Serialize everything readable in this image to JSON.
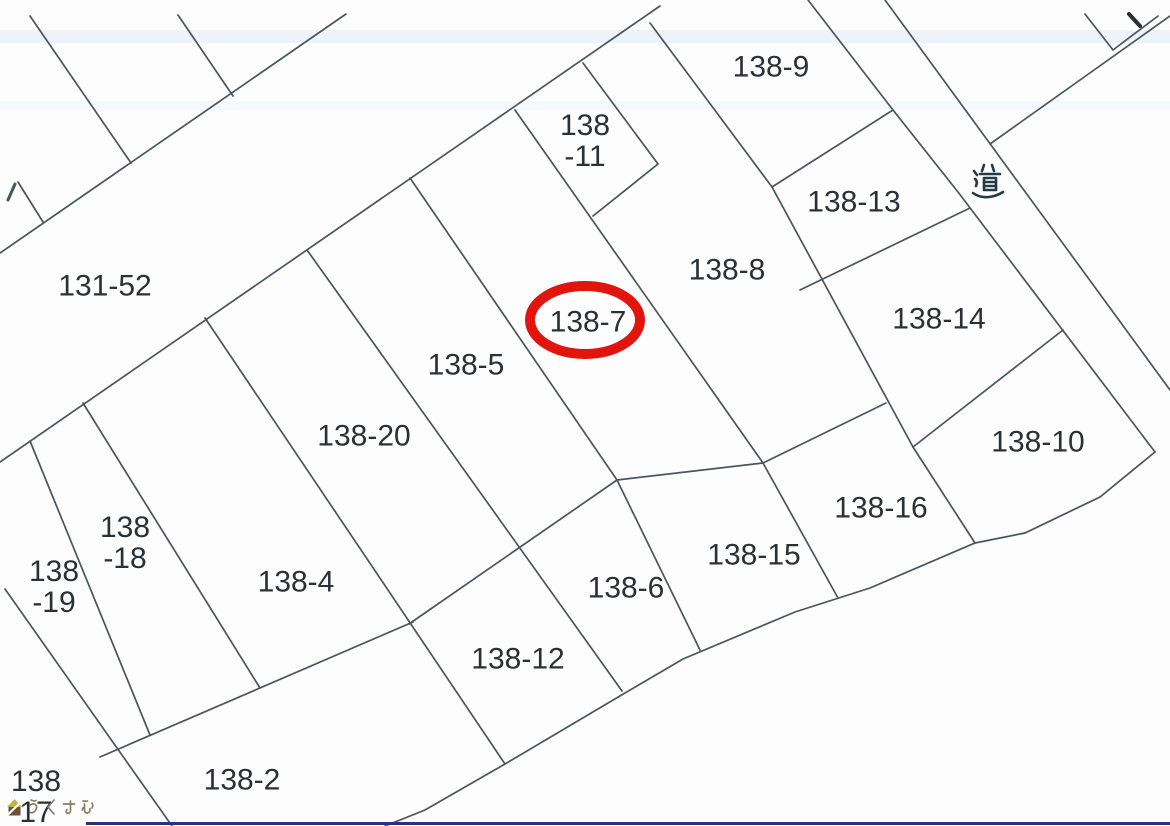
{
  "map": {
    "kind": "cadastral-parcel-map",
    "road_label": "道",
    "highlight": {
      "target_parcel": "138-7",
      "shape": "red-ellipse",
      "color": "#e2140e"
    }
  },
  "parcels": [
    {
      "id": "131-52",
      "lines": [
        "131-52"
      ]
    },
    {
      "id": "138-11",
      "lines": [
        "138",
        "-11"
      ]
    },
    {
      "id": "138-9",
      "lines": [
        "138-9"
      ]
    },
    {
      "id": "138-13",
      "lines": [
        "138-13"
      ]
    },
    {
      "id": "138-8",
      "lines": [
        "138-8"
      ]
    },
    {
      "id": "138-7",
      "lines": [
        "138-7"
      ],
      "highlighted": true
    },
    {
      "id": "138-5",
      "lines": [
        "138-5"
      ]
    },
    {
      "id": "138-14",
      "lines": [
        "138-14"
      ]
    },
    {
      "id": "138-20",
      "lines": [
        "138-20"
      ]
    },
    {
      "id": "138-10",
      "lines": [
        "138-10"
      ]
    },
    {
      "id": "138-16",
      "lines": [
        "138-16"
      ]
    },
    {
      "id": "138-15",
      "lines": [
        "138-15"
      ]
    },
    {
      "id": "138-18",
      "lines": [
        "138",
        "-18"
      ]
    },
    {
      "id": "138-19",
      "lines": [
        "138",
        "-19"
      ]
    },
    {
      "id": "138-4",
      "lines": [
        "138-4"
      ]
    },
    {
      "id": "138-6",
      "lines": [
        "138-6"
      ]
    },
    {
      "id": "138-12",
      "lines": [
        "138-12"
      ]
    },
    {
      "id": "138-2",
      "lines": [
        "138-2"
      ]
    },
    {
      "id": "138-17",
      "lines": [
        "138",
        "17"
      ]
    }
  ],
  "watermark": {
    "text": "らくすむ"
  },
  "colors": {
    "line": "#49555c",
    "text": "#2a3136",
    "road_text": "#223c46",
    "background": "#fdfdfe",
    "scan_line": "#24367a",
    "watermark_text": "#8d7a68",
    "watermark_logo_roof": "#c9b13d",
    "watermark_logo_body": "#6f5233",
    "highlight": "#e2140e"
  }
}
